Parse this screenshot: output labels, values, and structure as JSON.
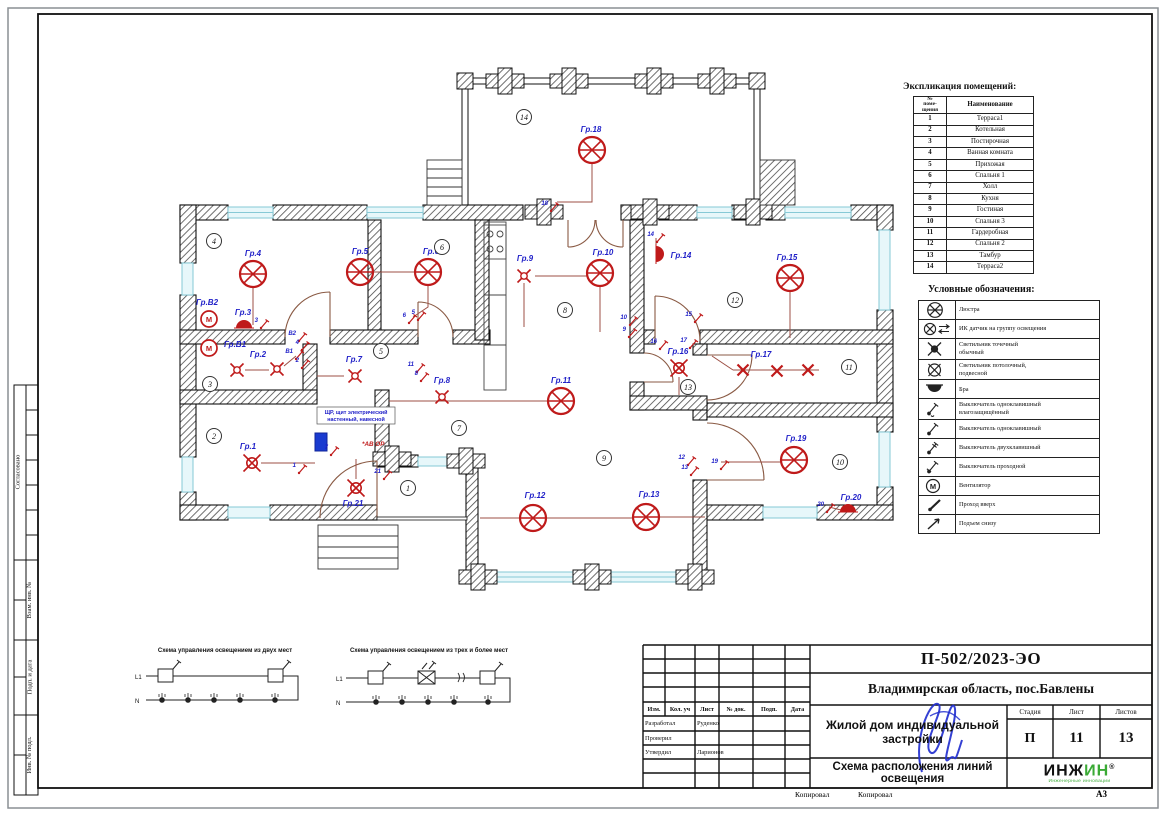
{
  "page": {
    "kopiroval_1": "Копировал",
    "kopiroval_2": "Копировал",
    "format": "А3"
  },
  "side_stamp": {
    "agreed": "Согласовано",
    "vzam": "Взам. инв. №",
    "podp": "Подп. и дата",
    "inv": "Инв. № подл."
  },
  "explication": {
    "title": "Экспликация помещений:",
    "col_num": "№\nпоме-\nщения",
    "col_name": "Наименование",
    "rows": [
      {
        "num": "1",
        "name": "Терраса1"
      },
      {
        "num": "2",
        "name": "Котельная"
      },
      {
        "num": "3",
        "name": "Постирочная"
      },
      {
        "num": "4",
        "name": "Ванная комната"
      },
      {
        "num": "5",
        "name": "Прихожая"
      },
      {
        "num": "6",
        "name": "Спальня 1"
      },
      {
        "num": "7",
        "name": "Холл"
      },
      {
        "num": "8",
        "name": "Кухня"
      },
      {
        "num": "9",
        "name": "Гостиная"
      },
      {
        "num": "10",
        "name": "Спальня 3"
      },
      {
        "num": "11",
        "name": "Гардеробная"
      },
      {
        "num": "12",
        "name": "Спальня 2"
      },
      {
        "num": "13",
        "name": "Тамбур"
      },
      {
        "num": "14",
        "name": "Терраса2"
      }
    ]
  },
  "legend": {
    "title": "Условные обозначения:",
    "items": [
      {
        "icon": "chandelier-icon",
        "label": "Люстра"
      },
      {
        "icon": "ir-sensor-icon",
        "label": "ИК датчик на группу освещения"
      },
      {
        "icon": "spot-light-icon",
        "label": "Светильник точечный\nобычный"
      },
      {
        "icon": "pendant-light-icon",
        "label": "Светильник потолочный,\nподвесной"
      },
      {
        "icon": "sconce-icon",
        "label": "Бра"
      },
      {
        "icon": "switch-waterproof-icon",
        "label": "Выключатель одноклавишный\nвлагозащищённый"
      },
      {
        "icon": "switch-single-icon",
        "label": "Выключатель одноклавишный"
      },
      {
        "icon": "switch-double-icon",
        "label": "Выключатель двухклавишный"
      },
      {
        "icon": "switch-pass-icon",
        "label": "Выключатель проходной"
      },
      {
        "icon": "fan-icon",
        "label": "Вентилятор"
      },
      {
        "icon": "pass-up-icon",
        "label": "Проход вверх"
      },
      {
        "icon": "rise-below-icon",
        "label": "Подъем снизу"
      }
    ]
  },
  "schematics": [
    {
      "title": "Схема управления освещением из двух мест",
      "l1": "L1",
      "n": "N"
    },
    {
      "title": "Схема управления освещением из трех и более мест",
      "l1": "L1",
      "n": "N"
    }
  ],
  "plan": {
    "panel_label": "ЩР, щит электрический\nнастенный, навесной",
    "panel_note": "*АВ ОР",
    "fixtures": [
      {
        "t": "ch",
        "x": 88,
        "y": 219,
        "label": "Гр.4",
        "lx": 88,
        "ly": 201
      },
      {
        "t": "ch",
        "x": 195,
        "y": 217,
        "label": "Гр.5",
        "lx": 195,
        "ly": 199
      },
      {
        "t": "ch",
        "x": 263,
        "y": 217,
        "label": "Гр.6",
        "lx": 266,
        "ly": 199
      },
      {
        "t": "ch",
        "x": 435,
        "y": 218,
        "label": "Гр.10",
        "lx": 438,
        "ly": 200
      },
      {
        "t": "ch",
        "x": 625,
        "y": 223,
        "label": "Гр.15",
        "lx": 622,
        "ly": 205
      },
      {
        "t": "ch",
        "x": 427,
        "y": 95,
        "label": "Гр.18",
        "lx": 426,
        "ly": 77
      },
      {
        "t": "ch",
        "x": 396,
        "y": 346,
        "label": "Гр.11",
        "lx": 396,
        "ly": 328
      },
      {
        "t": "ch",
        "x": 368,
        "y": 463,
        "label": "Гр.12",
        "lx": 370,
        "ly": 443
      },
      {
        "t": "ch",
        "x": 481,
        "y": 462,
        "label": "Гр.13",
        "lx": 484,
        "ly": 442
      },
      {
        "t": "ch",
        "x": 629,
        "y": 405,
        "label": "Гр.19",
        "lx": 631,
        "ly": 386
      },
      {
        "t": "sp",
        "x": 359,
        "y": 221,
        "label": "Гр.9",
        "lx": 360,
        "ly": 206
      },
      {
        "t": "sp",
        "x": 72,
        "y": 315,
        "label": "Гр.2",
        "lx": 93,
        "ly": 302
      },
      {
        "t": "sp",
        "x": 112,
        "y": 314,
        "label": ""
      },
      {
        "t": "sp",
        "x": 190,
        "y": 321,
        "label": "Гр.7",
        "lx": 189,
        "ly": 307
      },
      {
        "t": "sp",
        "x": 277,
        "y": 342,
        "label": "Гр.8",
        "lx": 277,
        "ly": 328
      },
      {
        "t": "spx",
        "x": 514,
        "y": 313,
        "label": "Гр.16",
        "lx": 513,
        "ly": 299
      },
      {
        "t": "spx",
        "x": 87,
        "y": 408,
        "label": "Гр.1",
        "lx": 83,
        "ly": 394
      },
      {
        "t": "spx",
        "x": 191,
        "y": 433,
        "label": "Гр.21",
        "lx": 188,
        "ly": 451
      },
      {
        "t": "x",
        "x": 578,
        "y": 315,
        "label": "Гр.17",
        "lx": 596,
        "ly": 302
      },
      {
        "t": "x",
        "x": 612,
        "y": 316,
        "label": ""
      },
      {
        "t": "x",
        "x": 643,
        "y": 315,
        "label": ""
      },
      {
        "t": "braU",
        "x": 79,
        "y": 273,
        "label": "Гр.3",
        "lx": 78,
        "ly": 260
      },
      {
        "t": "braR",
        "x": 491,
        "y": 199,
        "label": "Гр.14",
        "lx": 516,
        "ly": 203
      },
      {
        "t": "braU",
        "x": 683,
        "y": 457,
        "label": "Гр.20",
        "lx": 686,
        "ly": 445
      },
      {
        "t": "fan",
        "x": 44,
        "y": 264,
        "label": "Гр.В2",
        "lx": 42,
        "ly": 250
      },
      {
        "t": "fan",
        "x": 44,
        "y": 293,
        "label": "Гр.В1",
        "lx": 70,
        "ly": 292
      }
    ],
    "rooms": [
      {
        "n": "4",
        "x": 49,
        "y": 186
      },
      {
        "n": "6",
        "x": 277,
        "y": 192
      },
      {
        "n": "14",
        "x": 359,
        "y": 62
      },
      {
        "n": "5",
        "x": 216,
        "y": 296
      },
      {
        "n": "3",
        "x": 45,
        "y": 329
      },
      {
        "n": "2",
        "x": 49,
        "y": 381
      },
      {
        "n": "1",
        "x": 243,
        "y": 433
      },
      {
        "n": "7",
        "x": 294,
        "y": 373
      },
      {
        "n": "8",
        "x": 400,
        "y": 255
      },
      {
        "n": "9",
        "x": 439,
        "y": 403
      },
      {
        "n": "12",
        "x": 570,
        "y": 245
      },
      {
        "n": "13",
        "x": 523,
        "y": 332
      },
      {
        "n": "11",
        "x": 684,
        "y": 312
      },
      {
        "n": "10",
        "x": 675,
        "y": 407
      }
    ],
    "switches": [
      {
        "x": 93,
        "y": 267,
        "n": "3"
      },
      {
        "x": 131,
        "y": 280,
        "n": "В2"
      },
      {
        "x": 134,
        "y": 289,
        "n": "4"
      },
      {
        "x": 128,
        "y": 298,
        "n": "В1"
      },
      {
        "x": 134,
        "y": 307,
        "n": "2"
      },
      {
        "x": 163,
        "y": 394,
        "n": "7"
      },
      {
        "x": 131,
        "y": 412,
        "n": "1"
      },
      {
        "x": 216,
        "y": 418,
        "n": "21"
      },
      {
        "x": 249,
        "y": 311,
        "n": "11"
      },
      {
        "x": 253,
        "y": 320,
        "n": "8"
      },
      {
        "x": 241,
        "y": 262,
        "n": "6"
      },
      {
        "x": 250,
        "y": 259,
        "n": "5"
      },
      {
        "x": 383,
        "y": 150,
        "n": "18"
      },
      {
        "x": 489,
        "y": 181,
        "n": "14"
      },
      {
        "x": 462,
        "y": 264,
        "n": "10"
      },
      {
        "x": 461,
        "y": 276,
        "n": "9"
      },
      {
        "x": 492,
        "y": 288,
        "n": "16"
      },
      {
        "x": 527,
        "y": 261,
        "n": "15"
      },
      {
        "x": 522,
        "y": 287,
        "n": "17"
      },
      {
        "x": 520,
        "y": 404,
        "n": "12"
      },
      {
        "x": 523,
        "y": 414,
        "n": "13"
      },
      {
        "x": 553,
        "y": 408,
        "n": "19"
      },
      {
        "x": 659,
        "y": 451,
        "n": "20"
      }
    ],
    "wires": [
      [
        88,
        232,
        88,
        270
      ],
      [
        208,
        217,
        250,
        217
      ],
      [
        263,
        230,
        263,
        252,
        248,
        262
      ],
      [
        370,
        221,
        423,
        221
      ],
      [
        359,
        228,
        359,
        272
      ],
      [
        435,
        231,
        435,
        277
      ],
      [
        427,
        108,
        427,
        147,
        392,
        147
      ],
      [
        625,
        236,
        625,
        283
      ],
      [
        491,
        193,
        491,
        183
      ],
      [
        315,
        463,
        355,
        463
      ],
      [
        381,
        463,
        468,
        463
      ],
      [
        494,
        462,
        540,
        462
      ],
      [
        616,
        407,
        556,
        407
      ],
      [
        568,
        315,
        654,
        315
      ],
      [
        568,
        315,
        547,
        301
      ],
      [
        383,
        346,
        224,
        346
      ],
      [
        179,
        321,
        152,
        321
      ],
      [
        80,
        315,
        104,
        315
      ],
      [
        119,
        311,
        131,
        301
      ],
      [
        96,
        408,
        150,
        408
      ],
      [
        191,
        424,
        191,
        404
      ],
      [
        514,
        322,
        514,
        340
      ],
      [
        676,
        455,
        664,
        452
      ]
    ]
  },
  "title_block": {
    "doc_number": "П-502/2023-ЭО",
    "location": "Владимирская область, пос.Бавлены",
    "object": "Жилой дом индивидуальной застройки",
    "sheet_title": "Схема расположения линий освещения",
    "stage_label": "Стадия",
    "sheet_label": "Лист",
    "sheets_label": "Листов",
    "stage": "П",
    "sheet": "11",
    "sheets": "13",
    "cols": [
      "Изм.",
      "Кол. уч",
      "Лист",
      "№ док.",
      "Подп.",
      "Дата"
    ],
    "rows": [
      {
        "role": "Разработал",
        "name": "Руденко"
      },
      {
        "role": "Проверил",
        "name": ""
      },
      {
        "role": "Утвердил",
        "name": "Ларионов"
      }
    ],
    "logo": "ИНЖ",
    "logo2": "ИН",
    "logo_reg": "®",
    "logo_sub": "Инженерные инновации"
  }
}
